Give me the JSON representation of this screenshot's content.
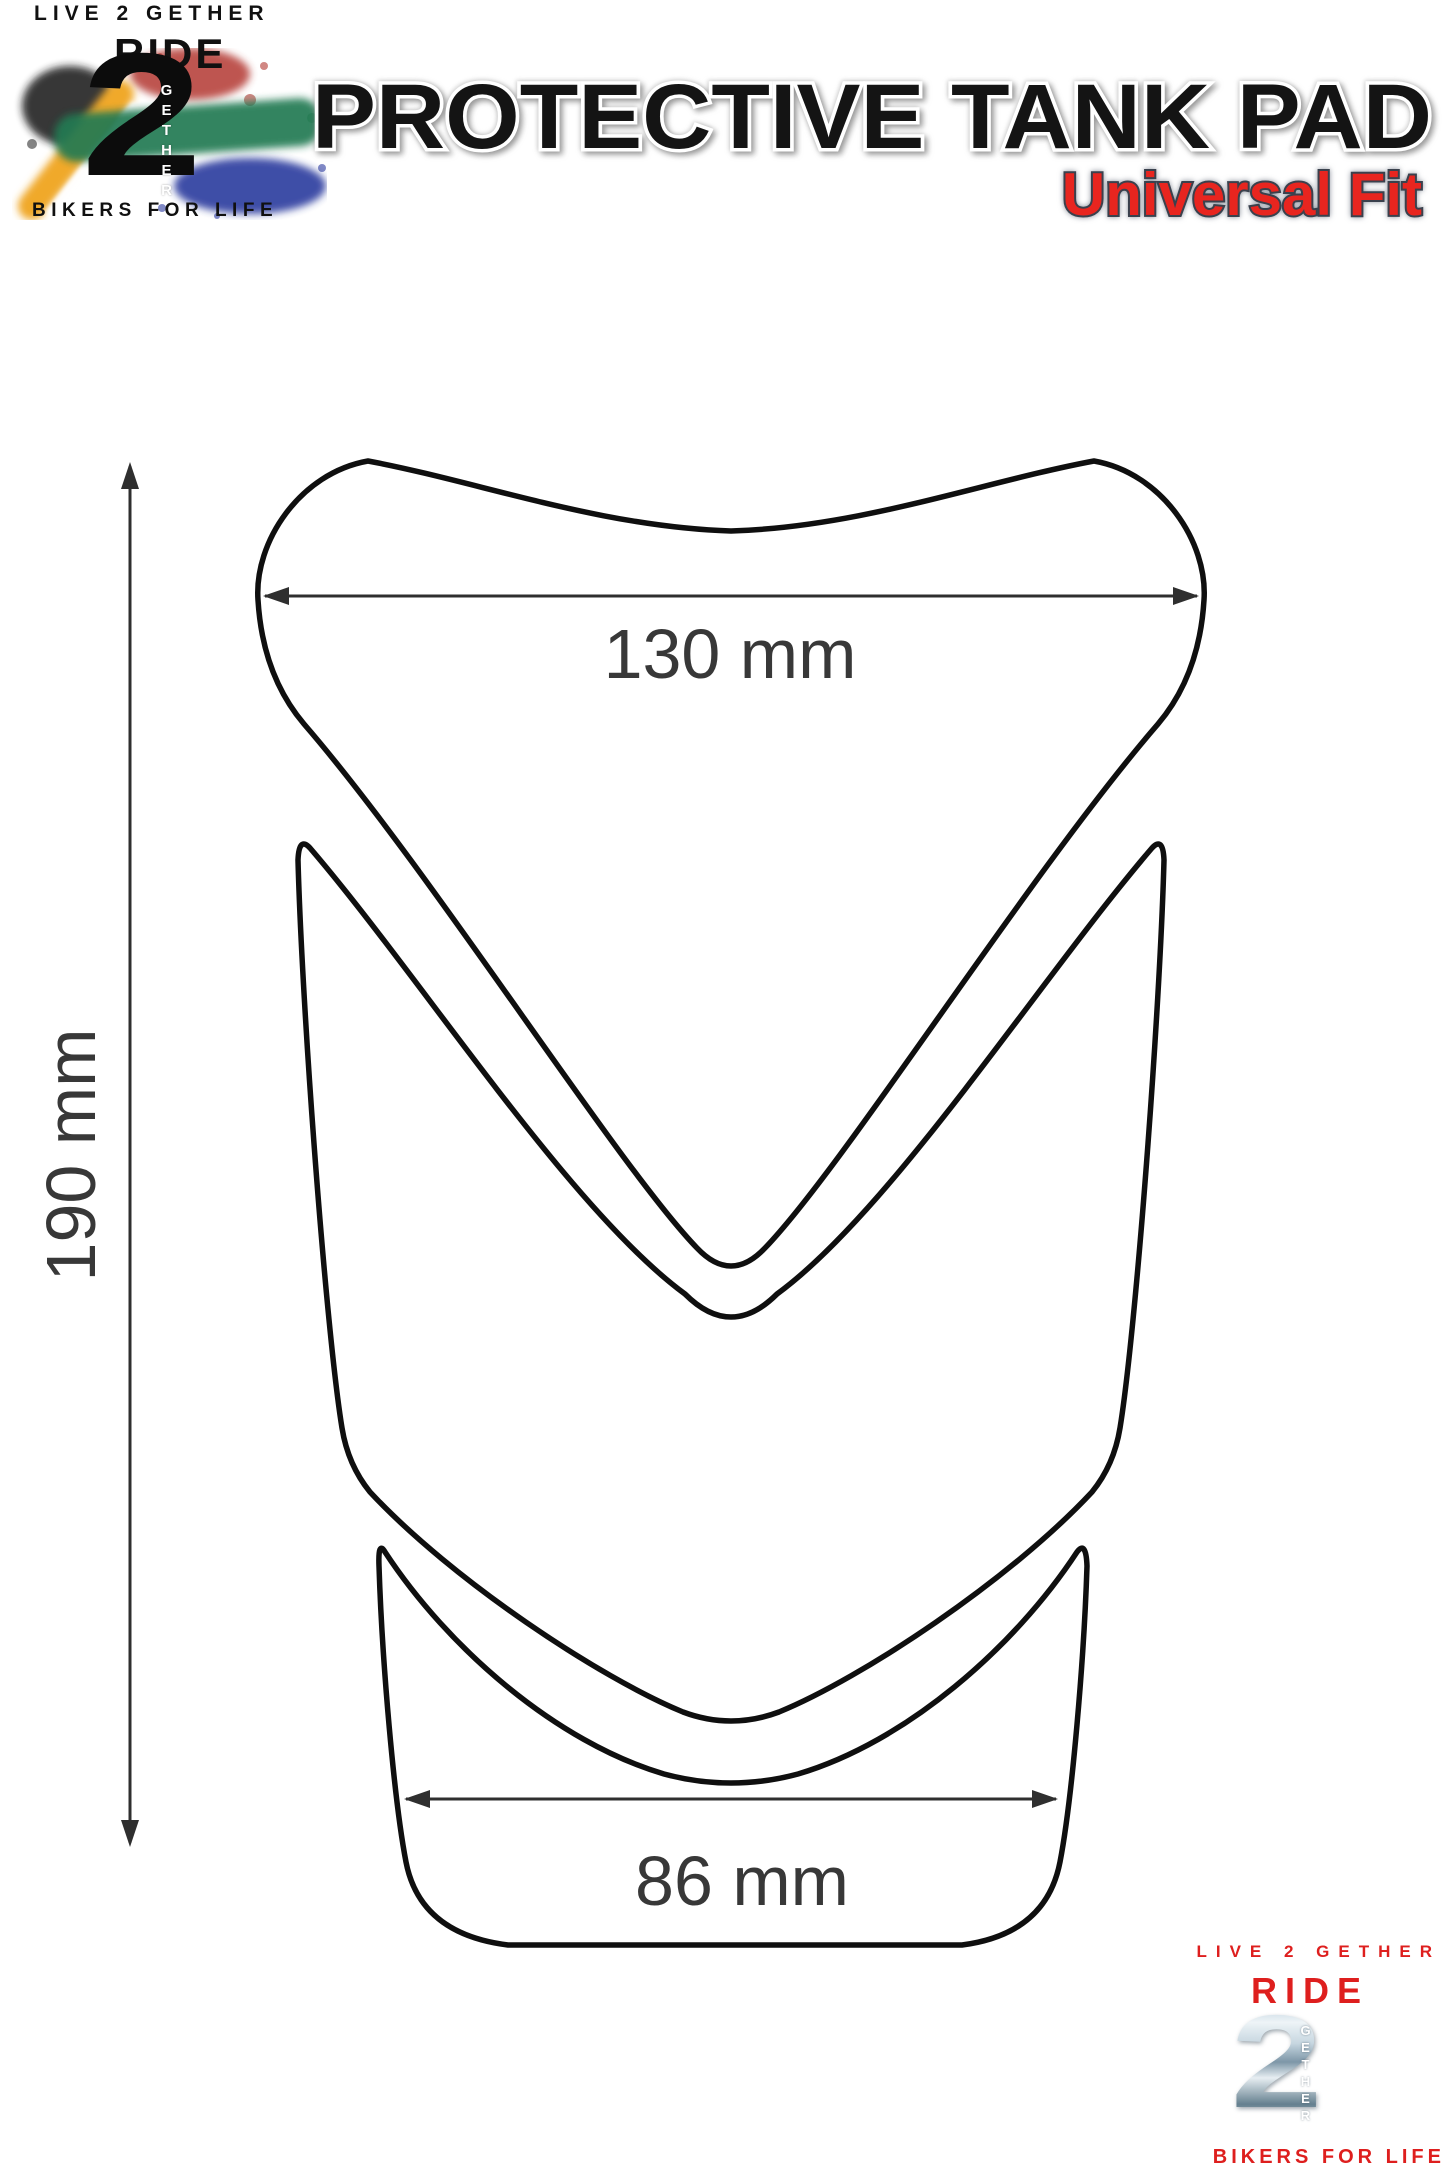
{
  "brand_top": {
    "live2gether": "LIVE 2 GETHER",
    "ride": "RIDE",
    "numeral": "2",
    "gether_vertical": "GETHER",
    "bikers": "BIKERS FOR LIFE"
  },
  "header": {
    "title": "PROTECTIVE TANK PAD",
    "subtitle": "Universal Fit"
  },
  "diagram": {
    "top_width_label": "130 mm",
    "height_label": "190 mm",
    "bottom_width_label": "86 mm"
  },
  "brand_bottom": {
    "live2gether": "LIVE 2 GETHER",
    "ride": "RIDE",
    "numeral": "2",
    "gether_vertical": "GETHER",
    "bikers": "BIKERS FOR LIFE"
  },
  "colors": {
    "accent_red": "#de1f1e",
    "outline_black": "#101010",
    "dimension_line": "#2f2f2f",
    "dimension_label": "#383838",
    "flag_green": "#237a52",
    "flag_gold": "#f0a92c",
    "flag_blue": "#2b3a9e",
    "flag_red": "#b33730",
    "flag_black": "#1d1d1d",
    "chrome_light": "#eef4f7",
    "chrome_dark": "#65808f"
  }
}
